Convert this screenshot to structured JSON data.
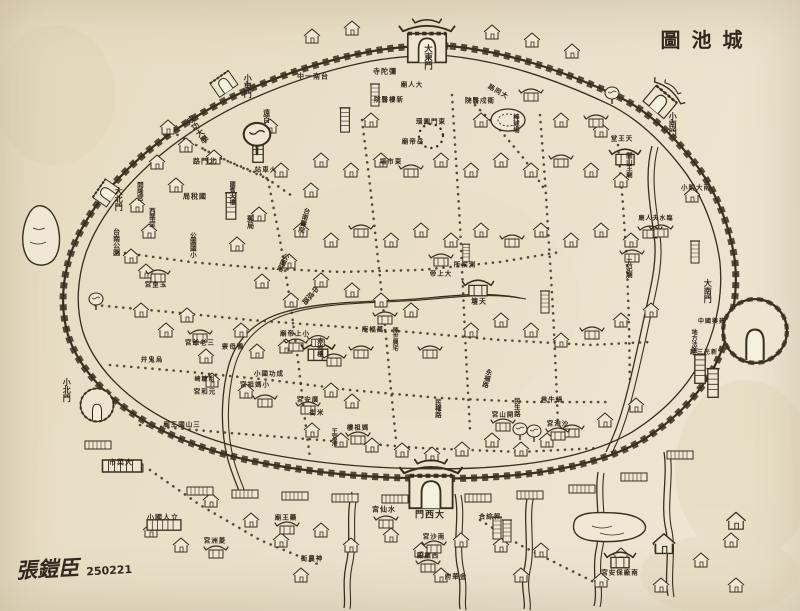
{
  "meta": {
    "width": 800,
    "height": 611,
    "subject": "hand-drawn old walled city map, east at top"
  },
  "title": {
    "text": "城池圖",
    "display": "圖池城"
  },
  "signature": {
    "artist": "張鎧臣",
    "date": "250221"
  },
  "palette": {
    "paper": "#eae0c9",
    "paper_light": "#f2ead8",
    "ink": "#38301f",
    "stain": "#d8c8a5"
  },
  "gates": [
    {
      "name": "大東門",
      "x": 427,
      "y": 57,
      "mode": "v",
      "size": 8.5
    },
    {
      "name": "小東門",
      "x": 247,
      "y": 86,
      "mode": "v",
      "size": 8
    },
    {
      "name": "大北門",
      "x": 118,
      "y": 199,
      "mode": "v",
      "size": 8
    },
    {
      "name": "小北門",
      "x": 66,
      "y": 390,
      "mode": "v",
      "size": 8
    },
    {
      "name": "小南門",
      "x": 672,
      "y": 124,
      "mode": "v",
      "size": 8
    },
    {
      "name": "大南門",
      "x": 707,
      "y": 291,
      "mode": "v",
      "size": 8
    },
    {
      "name": "大西門",
      "x": 430,
      "y": 516,
      "mode": "h",
      "display": "門西大",
      "size": 9
    }
  ],
  "labels": [
    {
      "name": "台南一中",
      "display": "中一南台",
      "x": 313,
      "y": 77,
      "mode": "h",
      "size": 7
    },
    {
      "name": "彌陀寺",
      "display": "寺陀彌",
      "x": 385,
      "y": 72,
      "mode": "h",
      "size": 7
    },
    {
      "name": "大人廟",
      "display": "廟人大",
      "x": 412,
      "y": 85,
      "mode": "h",
      "size": 6.5
    },
    {
      "name": "新樓醫院",
      "display": "院醫樓新",
      "x": 389,
      "y": 100,
      "mode": "h",
      "size": 6.5
    },
    {
      "name": "衛戍醫院",
      "display": "院醫戍衛",
      "x": 480,
      "y": 101,
      "mode": "h",
      "size": 6.5
    },
    {
      "name": "大同路",
      "display": "路同大",
      "x": 498,
      "y": 92,
      "mode": "h",
      "size": 6.5,
      "rot": 30
    },
    {
      "name": "東門圓環",
      "display": "環圓門東",
      "x": 431,
      "y": 122,
      "mode": "h",
      "size": 6.5
    },
    {
      "name": "岳帝廟",
      "display": "廟帝岳",
      "x": 413,
      "y": 142,
      "mode": "h",
      "size": 6.5
    },
    {
      "name": "東市場",
      "display": "場市東",
      "x": 391,
      "y": 162,
      "mode": "h",
      "size": 6.5
    },
    {
      "name": "火車站",
      "display": "站車火",
      "x": 266,
      "y": 170,
      "mode": "h",
      "size": 6.5
    },
    {
      "name": "北門路",
      "display": "路門北",
      "x": 205,
      "y": 162,
      "mode": "h",
      "size": 7
    },
    {
      "name": "成功大學",
      "x": 197,
      "y": 130,
      "mode": "v",
      "size": 8,
      "rot": -35
    },
    {
      "name": "遠百",
      "x": 266,
      "y": 116,
      "mode": "v",
      "size": 7
    },
    {
      "name": "棒球場",
      "x": 515,
      "y": 123,
      "mode": "v",
      "size": 6.5
    },
    {
      "name": "天王堂",
      "display": "堂王天",
      "x": 622,
      "y": 139,
      "mode": "h",
      "size": 6.5
    },
    {
      "name": "開山王廟",
      "x": 628,
      "y": 165,
      "mode": "v",
      "size": 6.5
    },
    {
      "name": "南大附小",
      "display": "小附大南",
      "x": 696,
      "y": 188,
      "mode": "h",
      "size": 6.5
    },
    {
      "name": "臨水夫人廟",
      "display": "廟人夫水臨",
      "x": 656,
      "y": 219,
      "mode": "h",
      "size": 6
    },
    {
      "name": "五妃廟",
      "x": 628,
      "y": 268,
      "mode": "v",
      "size": 6.5
    },
    {
      "name": "建興國中",
      "display": "中國興建",
      "x": 712,
      "y": 322,
      "mode": "h",
      "size": 6
    },
    {
      "name": "地方法院",
      "x": 693,
      "y": 341,
      "mode": "v",
      "size": 6
    },
    {
      "name": "新光三越",
      "display": "越三光新",
      "x": 704,
      "y": 353,
      "mode": "h",
      "size": 6
    },
    {
      "name": "開隆宮",
      "x": 139,
      "y": 191,
      "mode": "v",
      "size": 6.5
    },
    {
      "name": "國稅局",
      "display": "局稅國",
      "x": 195,
      "y": 197,
      "mode": "h",
      "size": 7
    },
    {
      "name": "西華堂",
      "x": 151,
      "y": 217,
      "mode": "v",
      "size": 6.5
    },
    {
      "name": "郵局",
      "x": 250,
      "y": 222,
      "mode": "v",
      "size": 7
    },
    {
      "name": "台南醫院",
      "x": 303,
      "y": 220,
      "mode": "v",
      "size": 6.5,
      "rot": 15
    },
    {
      "name": "公園國小",
      "x": 192,
      "y": 245,
      "mode": "v",
      "size": 6.5
    },
    {
      "name": "公園路",
      "x": 282,
      "y": 262,
      "mode": "v",
      "size": 6.5,
      "rot": 25
    },
    {
      "name": "台南公園",
      "x": 116,
      "y": 242,
      "mode": "v",
      "size": 7
    },
    {
      "name": "玉皇宮",
      "display": "宮皇玉",
      "x": 156,
      "y": 285,
      "mode": "h",
      "size": 6.5
    },
    {
      "name": "國賓大樓",
      "x": 231,
      "y": 193,
      "mode": "v",
      "size": 6
    },
    {
      "name": "中成路",
      "x": 310,
      "y": 295,
      "mode": "v",
      "size": 7,
      "rot": 40
    },
    {
      "name": "測候所",
      "display": "所候測",
      "x": 465,
      "y": 265,
      "mode": "h",
      "size": 6.5
    },
    {
      "name": "大上帝",
      "display": "帝上大",
      "x": 441,
      "y": 274,
      "mode": "h",
      "size": 6.5
    },
    {
      "name": "天壇",
      "display": "壇天",
      "x": 479,
      "y": 302,
      "mode": "h",
      "size": 7
    },
    {
      "name": "萬福庵",
      "display": "庵福萬",
      "x": 373,
      "y": 330,
      "mode": "h",
      "size": 6.5
    },
    {
      "name": "陳世興宅",
      "x": 394,
      "y": 339,
      "mode": "v",
      "size": 6
    },
    {
      "name": "小上帝廟",
      "display": "廟帝上小",
      "x": 295,
      "y": 334,
      "mode": "h",
      "size": 6.5
    },
    {
      "name": "赤崁樓",
      "x": 319,
      "y": 347,
      "mode": "v",
      "size": 6.5
    },
    {
      "name": "永福路",
      "x": 486,
      "y": 378,
      "mode": "v",
      "size": 6.5,
      "rot": 15
    },
    {
      "name": "民權路",
      "x": 437,
      "y": 408,
      "mode": "v",
      "size": 6.5
    },
    {
      "name": "三老爺宮",
      "display": "宮爺老三",
      "x": 200,
      "y": 343,
      "mode": "h",
      "size": 6.5
    },
    {
      "name": "鴨母寮",
      "display": "寮母鴨",
      "x": 233,
      "y": 347,
      "mode": "h",
      "size": 6.5
    },
    {
      "name": "烏鬼井",
      "display": "井鬼烏",
      "x": 152,
      "y": 360,
      "mode": "h",
      "size": 6.5
    },
    {
      "name": "成功國小",
      "display": "小國功成",
      "x": 269,
      "y": 374,
      "mode": "h",
      "size": 6.5
    },
    {
      "name": "粗糠崎",
      "display": "崎糠粗",
      "x": 205,
      "y": 380,
      "mode": "h",
      "size": 6
    },
    {
      "name": "小媽祖宮",
      "display": "宮祖媽小",
      "x": 255,
      "y": 385,
      "mode": "h",
      "size": 6.5
    },
    {
      "name": "元和宮",
      "display": "宮和元",
      "x": 205,
      "y": 392,
      "mode": "h",
      "size": 6.5
    },
    {
      "name": "三山國王廟",
      "display": "廟王國山三",
      "x": 182,
      "y": 425,
      "mode": "h",
      "size": 6.5
    },
    {
      "name": "廣安宮",
      "display": "宮安廣",
      "x": 308,
      "y": 400,
      "mode": "h",
      "size": 6.5
    },
    {
      "name": "米街",
      "display": "街米",
      "x": 317,
      "y": 413,
      "mode": "h",
      "size": 6.5
    },
    {
      "name": "媽祖樓",
      "display": "樓祖媽",
      "x": 358,
      "y": 428,
      "mode": "h",
      "size": 6.5
    },
    {
      "name": "王宮港",
      "x": 333,
      "y": 437,
      "mode": "v",
      "size": 6
    },
    {
      "name": "民生路",
      "x": 516,
      "y": 407,
      "mode": "v",
      "size": 6.5
    },
    {
      "name": "開山宮",
      "display": "宮山開",
      "x": 503,
      "y": 415,
      "mode": "h",
      "size": 6.5
    },
    {
      "name": "蝸牛巷",
      "display": "巷牛蝸",
      "x": 552,
      "y": 400,
      "mode": "h",
      "size": 6.5
    },
    {
      "name": "沙淘宮",
      "display": "宮淘沙",
      "x": 558,
      "y": 424,
      "mode": "h",
      "size": 6.5
    },
    {
      "name": "大菜市",
      "display": "市菜大",
      "x": 121,
      "y": 463,
      "mode": "h",
      "size": 7
    },
    {
      "name": "立人國小",
      "display": "小國人立",
      "x": 163,
      "y": 518,
      "mode": "h",
      "size": 7
    },
    {
      "name": "菱洲宮",
      "display": "宮洲菱",
      "x": 215,
      "y": 541,
      "mode": "h",
      "size": 6.5
    },
    {
      "name": "藥王廟",
      "display": "廟王藥",
      "x": 286,
      "y": 518,
      "mode": "h",
      "size": 6.5
    },
    {
      "name": "水仙宮",
      "display": "宮仙水",
      "x": 384,
      "y": 510,
      "mode": "h",
      "size": 7
    },
    {
      "name": "郭綜合",
      "display": "合綜郭",
      "x": 490,
      "y": 517,
      "mode": "h",
      "size": 6.5
    },
    {
      "name": "南沙宮",
      "display": "宮沙南",
      "x": 434,
      "y": 537,
      "mode": "h",
      "size": 6.5
    },
    {
      "name": "神農街",
      "display": "街農神",
      "x": 312,
      "y": 559,
      "mode": "h",
      "size": 6.5
    },
    {
      "name": "西羅殿",
      "display": "殿羅西",
      "x": 428,
      "y": 556,
      "mode": "h",
      "size": 6.5
    },
    {
      "name": "金華府",
      "display": "府華金",
      "x": 456,
      "y": 577,
      "mode": "h",
      "size": 6.5
    },
    {
      "name": "南廠保安宮",
      "display": "宮安保廠南",
      "x": 620,
      "y": 573,
      "mode": "h",
      "size": 6.5
    }
  ],
  "geometry": {
    "wall": "M450,46 C510,52 565,72 615,95 C650,111 678,140 700,170 C718,196 731,230 735,262 C738,292 733,325 719,357 C704,390 678,418 643,440 C605,462 556,472 505,476 C470,479 440,479 408,478 C360,477 310,472 262,463 C215,454 170,438 135,415 C103,394 78,366 68,335 C60,308 62,278 72,250 C84,219 104,192 130,167 C158,140 192,117 230,98 C268,80 312,64 358,54 C390,47 420,45 450,46 Z",
    "roads": [
      "165,128 220,158 262,175 295,198",
      "118,252 190,262 260,268 340,272 420,270 500,262 560,252",
      "95,305 170,312 250,320 330,326 410,332 500,340 590,345 650,342",
      "110,365 190,372 270,380 350,390 440,398 530,402 610,402",
      "140,425 230,433 320,440 420,448 520,452 600,448",
      "268,180 280,240 290,300 298,360 305,420 310,458",
      "362,120 370,185 377,250 384,315 390,380 396,440",
      "452,95 456,160 460,225 463,290 466,355 470,430",
      "540,115 545,180 549,245 553,310 556,375 558,425",
      "618,145 623,205 627,265 629,325 630,385",
      "470,100 500,130 525,160 545,190",
      "205,150 236,165 266,178",
      "150,470 200,505 260,540 320,565",
      "480,520 520,545 560,565 600,585"
    ],
    "roundabout": {
      "cx": 431,
      "cy": 136,
      "r": 12
    },
    "stadium": {
      "cx": 508,
      "cy": 120,
      "rx": 17,
      "ry": 11
    },
    "rivers": [
      "M520,298 C480,290 440,298 400,300 C360,302 320,302 285,312 C255,320 235,340 228,368 C221,396 220,430 228,460 C233,478 238,486 240,495",
      "M652,146 C644,175 650,205 654,235 C658,262 650,290 644,318 C638,346 632,375 624,404 C618,426 612,440 606,452"
    ],
    "channels": [
      "M352,492 C345,515 352,540 346,565 C342,585 346,598 344,608",
      "M455,494 C460,518 452,545 458,570 C462,588 458,600 460,609",
      "M528,494 C522,518 530,545 524,570 C520,588 526,600 524,609",
      "M598,472 C594,498 602,525 596,550 C592,572 598,592 594,606",
      "M664,452 C668,478 660,505 666,530 C670,552 664,575 668,596"
    ],
    "ponds": [
      "M30,212 C22,225 20,245 27,257 C33,268 50,268 56,256 C62,244 60,224 52,213 C45,204 36,203 30,212 Z",
      "M575,520 C570,532 578,540 595,541 C615,543 640,540 645,530 C648,521 635,514 615,513 C597,512 580,512 575,520 Z"
    ]
  },
  "decor": {
    "houses": [
      [
        168,
        128
      ],
      [
        186,
        146
      ],
      [
        157,
        163
      ],
      [
        214,
        158
      ],
      [
        176,
        186
      ],
      [
        137,
        206
      ],
      [
        149,
        232
      ],
      [
        131,
        257
      ],
      [
        146,
        272
      ],
      [
        141,
        311
      ],
      [
        166,
        331
      ],
      [
        187,
        316
      ],
      [
        206,
        357
      ],
      [
        241,
        331
      ],
      [
        257,
        352
      ],
      [
        212,
        381
      ],
      [
        246,
        392
      ],
      [
        286,
        347
      ],
      [
        331,
        391
      ],
      [
        352,
        402
      ],
      [
        312,
        431
      ],
      [
        341,
        441
      ],
      [
        372,
        446
      ],
      [
        402,
        451
      ],
      [
        432,
        455
      ],
      [
        462,
        450
      ],
      [
        492,
        441
      ],
      [
        521,
        450
      ],
      [
        547,
        441
      ],
      [
        605,
        421
      ],
      [
        636,
        406
      ],
      [
        291,
        301
      ],
      [
        321,
        281
      ],
      [
        352,
        291
      ],
      [
        381,
        301
      ],
      [
        411,
        311
      ],
      [
        471,
        331
      ],
      [
        501,
        321
      ],
      [
        531,
        331
      ],
      [
        561,
        341
      ],
      [
        621,
        321
      ],
      [
        651,
        311
      ],
      [
        301,
        231
      ],
      [
        331,
        241
      ],
      [
        391,
        241
      ],
      [
        421,
        231
      ],
      [
        451,
        241
      ],
      [
        481,
        231
      ],
      [
        541,
        231
      ],
      [
        571,
        241
      ],
      [
        601,
        231
      ],
      [
        631,
        241
      ],
      [
        321,
        161
      ],
      [
        351,
        171
      ],
      [
        381,
        161
      ],
      [
        441,
        161
      ],
      [
        471,
        171
      ],
      [
        501,
        161
      ],
      [
        531,
        171
      ],
      [
        591,
        171
      ],
      [
        621,
        181
      ],
      [
        481,
        121
      ],
      [
        371,
        121
      ],
      [
        561,
        121
      ],
      [
        601,
        131
      ],
      [
        281,
        171
      ],
      [
        311,
        191
      ],
      [
        259,
        215
      ],
      [
        237,
        245
      ],
      [
        262,
        282
      ],
      [
        289,
        262
      ],
      [
        251,
        521
      ],
      [
        281,
        541
      ],
      [
        321,
        531
      ],
      [
        351,
        546
      ],
      [
        391,
        536
      ],
      [
        421,
        551
      ],
      [
        461,
        541
      ],
      [
        501,
        546
      ],
      [
        541,
        551
      ],
      [
        621,
        556
      ],
      [
        661,
        546
      ],
      [
        701,
        561
      ],
      [
        731,
        541
      ],
      [
        181,
        546
      ],
      [
        151,
        531
      ],
      [
        211,
        501
      ],
      [
        301,
        576
      ],
      [
        441,
        576
      ],
      [
        521,
        576
      ],
      [
        601,
        581
      ],
      [
        661,
        586
      ],
      [
        736,
        586
      ],
      [
        312,
        37
      ],
      [
        352,
        29
      ],
      [
        492,
        33
      ],
      [
        532,
        41
      ],
      [
        572,
        52
      ],
      [
        692,
        196
      ],
      [
        270,
        127
      ],
      [
        664,
        545,
        1.4
      ],
      [
        736,
        522,
        1.2
      ]
    ],
    "temples": [
      [
        200,
        336
      ],
      [
        158,
        276
      ],
      [
        265,
        401
      ],
      [
        361,
        352
      ],
      [
        430,
        352
      ],
      [
        478,
        288,
        1.3
      ],
      [
        441,
        260
      ],
      [
        625,
        157,
        1.3
      ],
      [
        650,
        232
      ],
      [
        632,
        256
      ],
      [
        572,
        431
      ],
      [
        592,
        333
      ],
      [
        512,
        241
      ],
      [
        411,
        171
      ],
      [
        361,
        231
      ],
      [
        561,
        161
      ],
      [
        661,
        231
      ],
      [
        385,
        318
      ],
      [
        296,
        345
      ],
      [
        434,
        547
      ],
      [
        386,
        522
      ],
      [
        620,
        560,
        1.3
      ],
      [
        216,
        552
      ],
      [
        287,
        528
      ],
      [
        428,
        566
      ],
      [
        308,
        408
      ],
      [
        358,
        438
      ],
      [
        503,
        425
      ],
      [
        558,
        434
      ],
      [
        318,
        352,
        1.4
      ],
      [
        318,
        341,
        0.9
      ],
      [
        334,
        360
      ],
      [
        596,
        121
      ],
      [
        531,
        95
      ]
    ],
    "towers": [
      [
        258,
        148,
        1.3
      ],
      [
        231,
        206,
        1.2
      ],
      [
        700,
        369,
        1.3
      ],
      [
        713,
        383,
        1.3
      ],
      [
        545,
        302
      ],
      [
        695,
        252
      ],
      [
        466,
        253,
        0.8
      ],
      [
        497,
        528
      ],
      [
        507,
        531
      ],
      [
        345,
        120,
        1.1
      ],
      [
        375,
        95
      ]
    ],
    "trees": [
      [
        257,
        140,
        1.9
      ],
      [
        520,
        432
      ],
      [
        534,
        434
      ],
      [
        96,
        302
      ],
      [
        612,
        96
      ]
    ],
    "longs": [
      [
        200,
        491
      ],
      [
        245,
        494
      ],
      [
        295,
        496
      ],
      [
        345,
        498
      ],
      [
        395,
        499
      ],
      [
        478,
        498
      ],
      [
        530,
        495
      ],
      [
        582,
        489
      ],
      [
        634,
        477
      ],
      [
        130,
        468
      ],
      [
        98,
        445
      ],
      [
        680,
        455
      ],
      [
        122,
        466,
        1.5
      ],
      [
        164,
        525,
        1.3
      ]
    ]
  }
}
